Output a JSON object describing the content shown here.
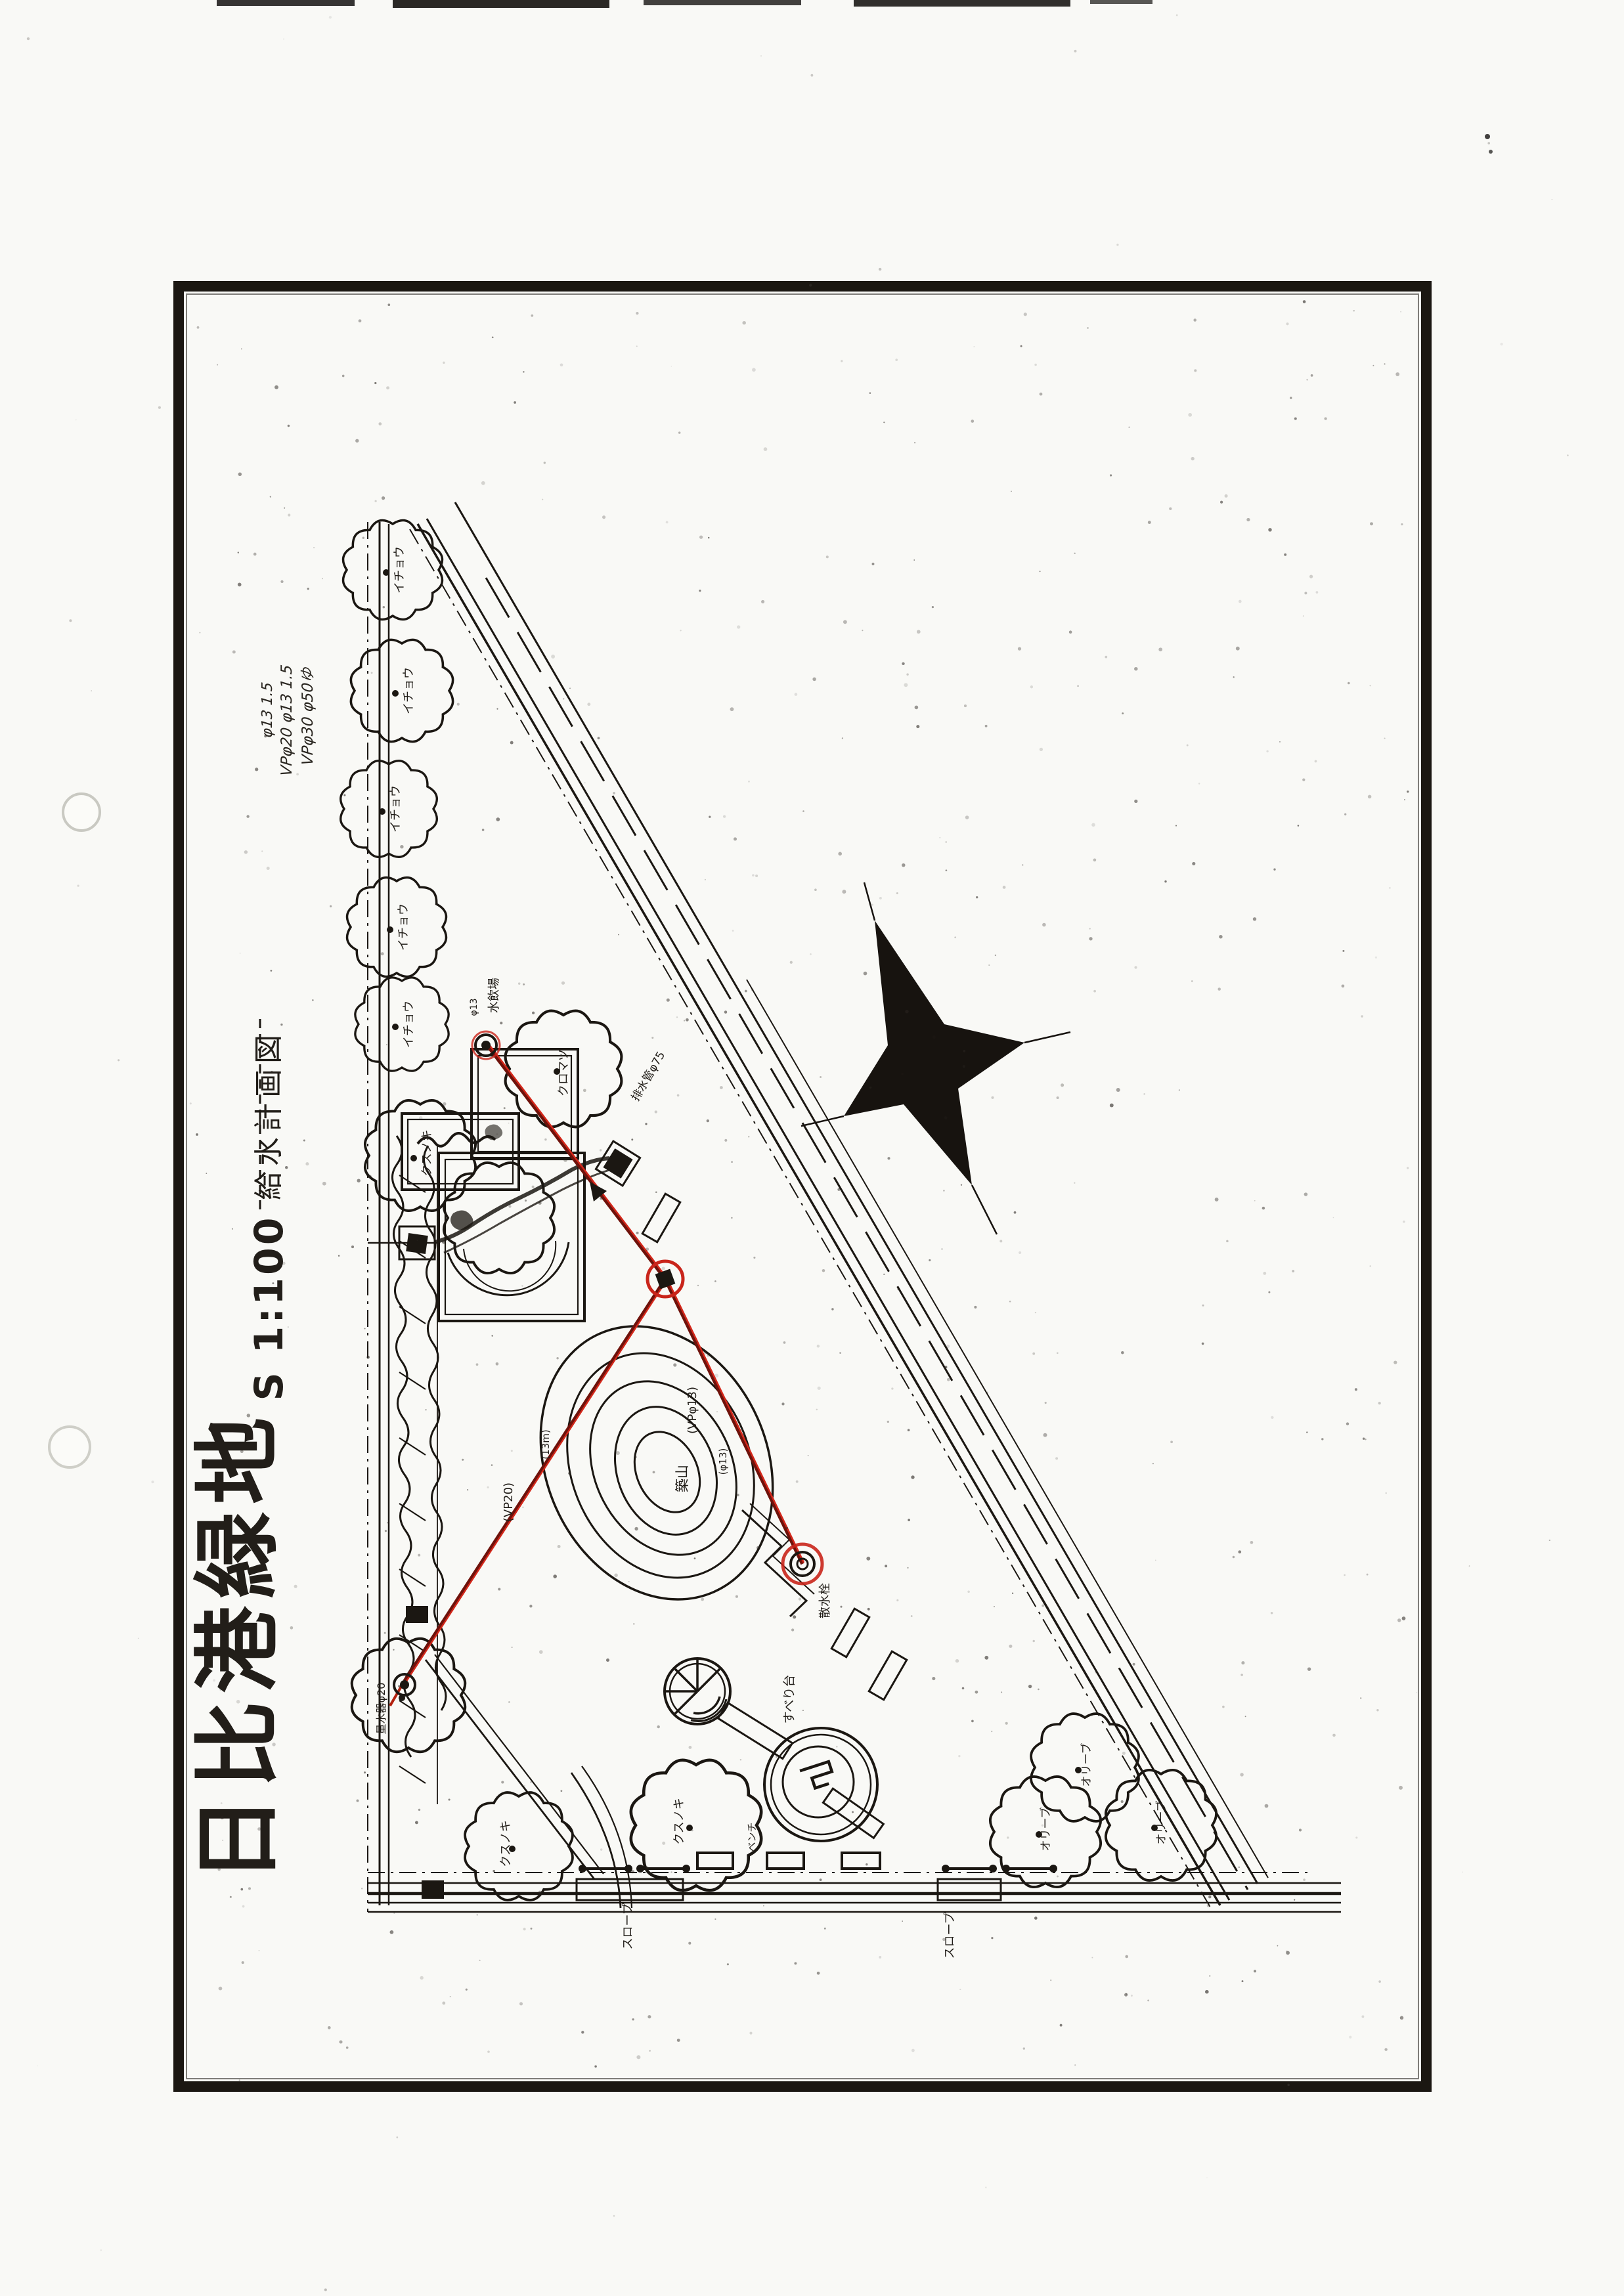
{
  "title_block": {
    "title": "日比港緑地",
    "scale": "S 1:100",
    "subtitle": "給水計画図",
    "handwritten_notes": [
      "VPφ30 φ50ゆ",
      "VPφ20 φ13 1.5",
      "φ13 1.5"
    ]
  },
  "plan": {
    "tree_labels": {
      "ginkgo": "イチョウ",
      "camphor": "クスノキ",
      "black_pine": "クロマツ",
      "olive": "オリーブ"
    },
    "water_supply": {
      "drinking_fountain": "水飲場",
      "drinking_fountain_size": "φ13",
      "pipe_label_a": "(VPφ13)",
      "pipe_label_a2": "(φ13)",
      "pipe_label_b": "(VP20)",
      "pipe_label_b2": "(13m)",
      "water_meter": "量水器φ20",
      "sprinkler_tap": "散水栓"
    },
    "features": {
      "mound": "築山",
      "slide": "すべり台",
      "bench": "ベンチ",
      "ramp_south": "スロープ",
      "ramp_east": "スロープ",
      "road_pipe": "排水管φ75"
    },
    "colors": {
      "ink": "#1b1712",
      "red_line": "#c9251b",
      "paper": "#f8f7f3"
    }
  }
}
